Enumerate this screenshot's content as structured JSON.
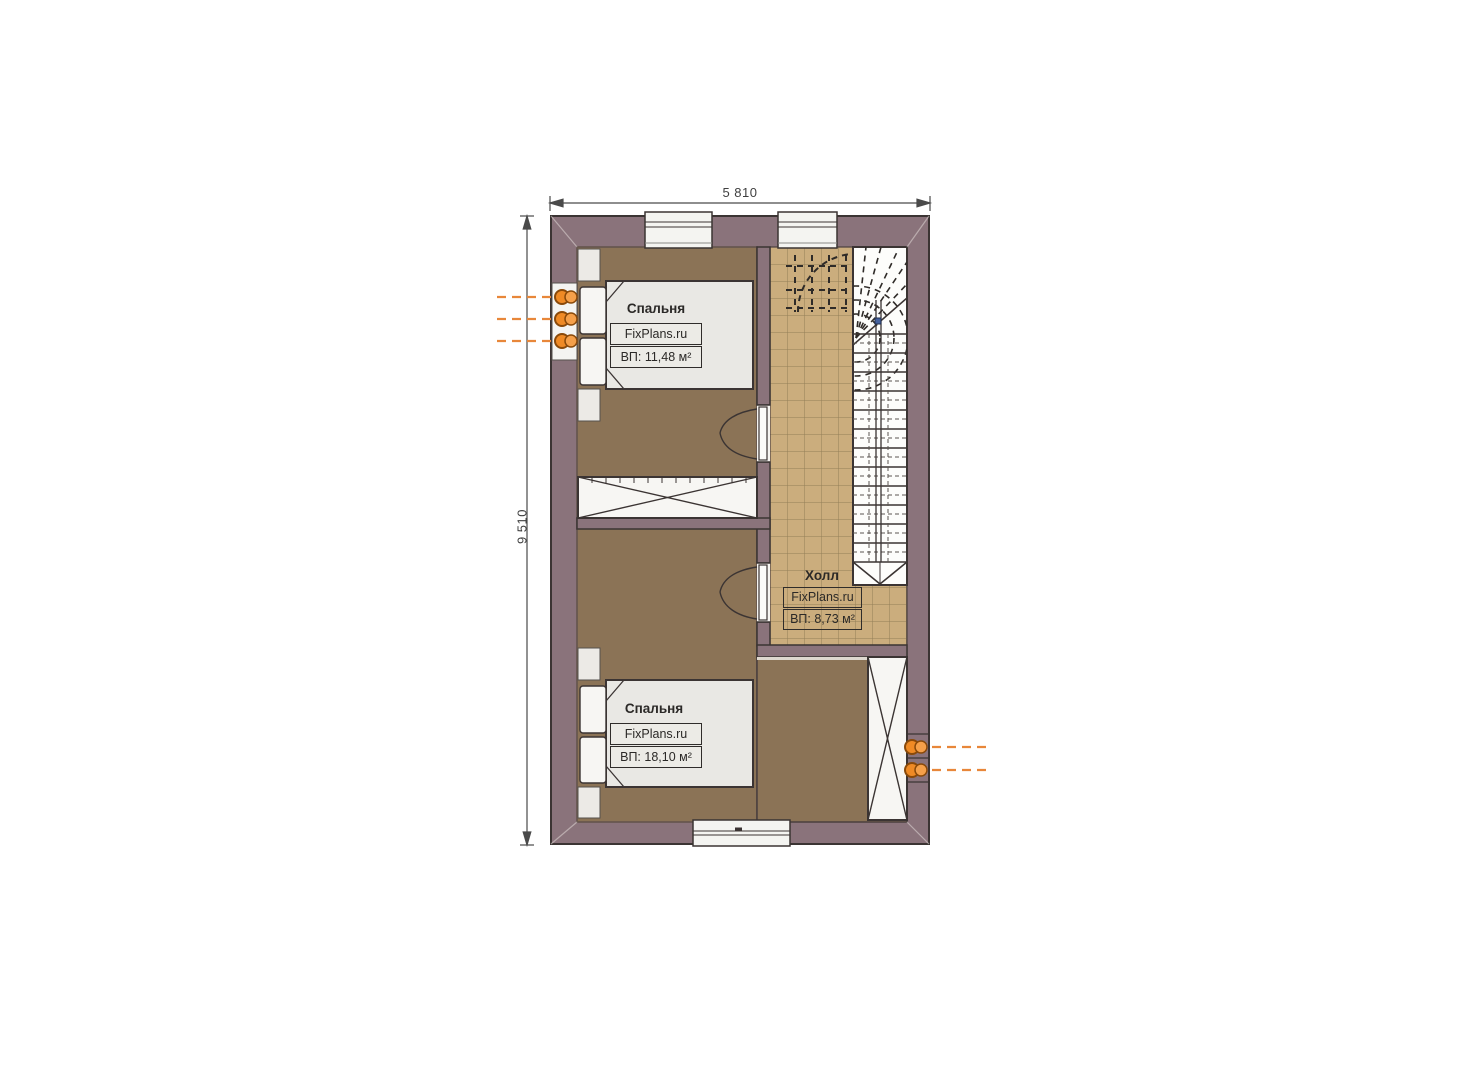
{
  "plan": {
    "type": "floor-plan",
    "dimensions": {
      "width_label": "5 810",
      "height_label": "9 510"
    },
    "rooms": [
      {
        "name": "Спальня",
        "watermark": "FixPlans.ru",
        "area": "ВП: 11,48 м²"
      },
      {
        "name": "Спальня",
        "watermark": "FixPlans.ru",
        "area": "ВП: 18,10 м²"
      },
      {
        "name": "Холл",
        "watermark": "FixPlans.ru",
        "area": "ВП: 8,73 м²"
      }
    ],
    "colors": {
      "wall": "#8a737b",
      "bedroom_floor": "#8b7356",
      "hall_tile": "#cbad7d",
      "tile_grid": "#937f58",
      "stair_background": "#fdfdfb",
      "furniture": "#edece8",
      "outline": "#3b3433",
      "radiator": "#ef8a25",
      "radiator_line": "#e8873a",
      "dimension": "#3f3f3f"
    }
  }
}
